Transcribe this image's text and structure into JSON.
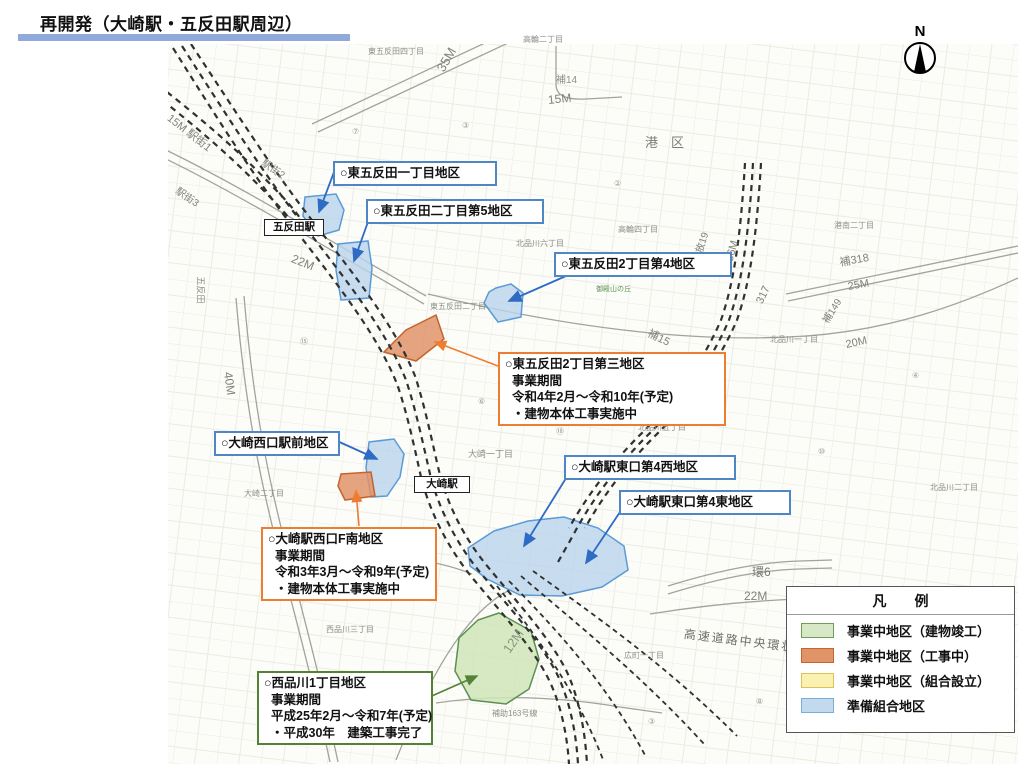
{
  "title": {
    "text": "再開発（大崎駅・五反田駅周辺）"
  },
  "north": {
    "label": "N"
  },
  "stations": [
    {
      "id": "gotanda-station",
      "label": "五反田駅",
      "x": 264,
      "y": 219,
      "w": 50
    },
    {
      "id": "osaki-station",
      "label": "大崎駅",
      "x": 414,
      "y": 476,
      "w": 46
    }
  ],
  "callouts": [
    {
      "id": "higashigotanda-1",
      "type": "blue",
      "x": 333,
      "y": 161,
      "w": 164,
      "lines": [
        "○東五反田一丁目地区"
      ]
    },
    {
      "id": "higashigotanda-2-5",
      "type": "blue",
      "x": 366,
      "y": 199,
      "w": 178,
      "lines": [
        "○東五反田二丁目第5地区"
      ]
    },
    {
      "id": "higashigotanda-2-4",
      "type": "blue",
      "x": 554,
      "y": 252,
      "w": 178,
      "lines": [
        "○東五反田2丁目第4地区"
      ]
    },
    {
      "id": "higashigotanda-2-3",
      "type": "orange",
      "x": 498,
      "y": 352,
      "w": 228,
      "lines": [
        "○東五反田2丁目第三地区",
        "事業期間",
        "令和4年2月～令和10年(予定)",
        "・建物本体工事実施中"
      ]
    },
    {
      "id": "osaki-west-ekimae",
      "type": "blue",
      "x": 214,
      "y": 431,
      "w": 126,
      "lines": [
        "○大崎西口駅前地区"
      ]
    },
    {
      "id": "osaki-east-4-west",
      "type": "blue",
      "x": 564,
      "y": 455,
      "w": 172,
      "lines": [
        "○大崎駅東口第4西地区"
      ]
    },
    {
      "id": "osaki-east-4-east",
      "type": "blue",
      "x": 619,
      "y": 490,
      "w": 172,
      "lines": [
        "○大崎駅東口第4東地区"
      ]
    },
    {
      "id": "osaki-west-f-south",
      "type": "orange",
      "x": 261,
      "y": 527,
      "w": 176,
      "lines": [
        "○大崎駅西口F南地区",
        "事業期間",
        "令和3年3月～令和9年(予定)",
        "・建物本体工事実施中"
      ]
    },
    {
      "id": "nishishinagawa-1",
      "type": "green",
      "x": 257,
      "y": 671,
      "w": 176,
      "lines": [
        "○西品川1丁目地区",
        "事業期間",
        "平成25年2月～令和7年(予定)",
        "・平成30年　建築工事完了"
      ]
    }
  ],
  "legend": {
    "title": "凡　　例",
    "items": [
      {
        "label": "事業中地区（建物竣工）",
        "fill": "#d7e8c6",
        "border": "#6f9e58"
      },
      {
        "label": "事業中地区（工事中）",
        "fill": "#e09468",
        "border": "#c2652f"
      },
      {
        "label": "事業中地区（組合設立）",
        "fill": "#faf0b0",
        "border": "#dcc25a"
      },
      {
        "label": "準備組合地区",
        "fill": "#c3d9ee",
        "border": "#79aed6"
      }
    ]
  },
  "colors": {
    "title_bar": "#8ea9da",
    "callout_blue": "#4f86c6",
    "callout_orange": "#ed7d31",
    "callout_green": "#538135",
    "zone_blue_fill": "#b9d5ec",
    "zone_blue_border": "#5b9bd5",
    "zone_orange_fill": "#e2936a",
    "zone_orange_border": "#c2652f",
    "zone_green_fill": "#cfe5ba",
    "zone_green_border": "#5d9150"
  },
  "map_labels": [
    {
      "t": "港　区",
      "x": 645,
      "y": 136,
      "s": 13,
      "c": "#7d7d76"
    },
    {
      "t": "高輪二丁目",
      "x": 523,
      "y": 36,
      "s": 8
    },
    {
      "t": "東五反田四丁目",
      "x": 368,
      "y": 48,
      "s": 8
    },
    {
      "t": "35M",
      "x": 440,
      "y": 64,
      "s": 13,
      "r": -60,
      "c": "#82827a"
    },
    {
      "t": "補14",
      "x": 556,
      "y": 76,
      "s": 10
    },
    {
      "t": "15M",
      "x": 548,
      "y": 94,
      "s": 12,
      "r": -6,
      "c": "#82827a"
    },
    {
      "t": "港南二丁目",
      "x": 834,
      "y": 222,
      "s": 8
    },
    {
      "t": "高輪四丁目",
      "x": 618,
      "y": 226,
      "s": 8
    },
    {
      "t": "北品川六丁目",
      "x": 516,
      "y": 240,
      "s": 8
    },
    {
      "t": "補318",
      "x": 840,
      "y": 258,
      "s": 11,
      "r": -10,
      "c": "#82827a"
    },
    {
      "t": "25M",
      "x": 848,
      "y": 282,
      "s": 11,
      "r": -10,
      "c": "#82827a"
    },
    {
      "t": "補149",
      "x": 826,
      "y": 318,
      "s": 10,
      "r": -58,
      "c": "#82827a"
    },
    {
      "t": "20M",
      "x": 846,
      "y": 340,
      "s": 11,
      "r": -12,
      "c": "#82827a"
    },
    {
      "t": "放19",
      "x": 700,
      "y": 248,
      "s": 10,
      "r": -72,
      "c": "#82827a"
    },
    {
      "t": "36M",
      "x": 730,
      "y": 256,
      "s": 11,
      "r": -75,
      "c": "#82827a"
    },
    {
      "t": "317",
      "x": 760,
      "y": 298,
      "s": 11,
      "r": -65,
      "c": "#82827a"
    },
    {
      "t": "補15",
      "x": 648,
      "y": 328,
      "s": 11,
      "r": 26,
      "c": "#82827a"
    },
    {
      "t": "北品川一丁目",
      "x": 770,
      "y": 336,
      "s": 8
    },
    {
      "t": "北品川五丁目",
      "x": 638,
      "y": 424,
      "s": 8
    },
    {
      "t": "大崎一丁目",
      "x": 468,
      "y": 450,
      "s": 9
    },
    {
      "t": "北品川二丁目",
      "x": 930,
      "y": 484,
      "s": 8
    },
    {
      "t": "大崎二丁目",
      "x": 244,
      "y": 490,
      "s": 8
    },
    {
      "t": "15M 駅街1",
      "x": 168,
      "y": 112,
      "s": 11,
      "r": 38,
      "c": "#82827a"
    },
    {
      "t": "駅街2",
      "x": 262,
      "y": 158,
      "s": 10,
      "r": 34,
      "c": "#82827a"
    },
    {
      "t": "駅街3",
      "x": 176,
      "y": 186,
      "s": 10,
      "r": 34,
      "c": "#82827a"
    },
    {
      "t": "22M",
      "x": 292,
      "y": 252,
      "s": 12,
      "r": 22,
      "c": "#82827a"
    },
    {
      "t": "五反田",
      "x": 200,
      "y": 272,
      "s": 9,
      "r": 90
    },
    {
      "t": "40M",
      "x": 228,
      "y": 366,
      "s": 12,
      "r": 82,
      "c": "#82827a"
    },
    {
      "t": "東五反田二丁目",
      "x": 430,
      "y": 303,
      "s": 8
    },
    {
      "t": "御殿山の丘",
      "x": 596,
      "y": 286,
      "s": 7,
      "c": "#5d9150"
    },
    {
      "t": "環6",
      "x": 752,
      "y": 566,
      "s": 12,
      "c": "#75756e"
    },
    {
      "t": "22M",
      "x": 744,
      "y": 590,
      "s": 12,
      "c": "#82827a"
    },
    {
      "t": "高速道路中央環状品川線",
      "x": 684,
      "y": 628,
      "s": 12,
      "r": 7,
      "c": "#6f6f68",
      "ls": 2
    },
    {
      "t": "12M",
      "x": 506,
      "y": 645,
      "s": 13,
      "r": -55,
      "c": "#88987e"
    },
    {
      "t": "補助163号線",
      "x": 492,
      "y": 710,
      "s": 8
    },
    {
      "t": "西品川三丁目",
      "x": 326,
      "y": 626,
      "s": 8
    },
    {
      "t": "広町一丁目",
      "x": 624,
      "y": 652,
      "s": 8
    },
    {
      "t": "南品川四",
      "x": 868,
      "y": 700,
      "s": 8
    },
    {
      "t": "⑦",
      "x": 352,
      "y": 128,
      "s": 8,
      "c": "#9a9a92"
    },
    {
      "t": "③",
      "x": 462,
      "y": 122,
      "s": 8,
      "c": "#9a9a92"
    },
    {
      "t": "②",
      "x": 614,
      "y": 180,
      "s": 8,
      "c": "#9a9a92"
    },
    {
      "t": "⑮",
      "x": 300,
      "y": 338,
      "s": 8,
      "c": "#9a9a92"
    },
    {
      "t": "⑥",
      "x": 478,
      "y": 398,
      "s": 8,
      "c": "#9a9a92"
    },
    {
      "t": "⑱",
      "x": 556,
      "y": 428,
      "s": 8,
      "c": "#9a9a92"
    },
    {
      "t": "⑤",
      "x": 698,
      "y": 468,
      "s": 8,
      "c": "#9a9a92"
    },
    {
      "t": "⑩",
      "x": 818,
      "y": 448,
      "s": 8,
      "c": "#9a9a92"
    },
    {
      "t": "④",
      "x": 912,
      "y": 372,
      "s": 8,
      "c": "#9a9a92"
    },
    {
      "t": "⑲",
      "x": 378,
      "y": 578,
      "s": 8,
      "c": "#9a9a92"
    },
    {
      "t": "③",
      "x": 648,
      "y": 718,
      "s": 8,
      "c": "#9a9a92"
    },
    {
      "t": "⑧",
      "x": 756,
      "y": 698,
      "s": 8,
      "c": "#9a9a92"
    }
  ]
}
